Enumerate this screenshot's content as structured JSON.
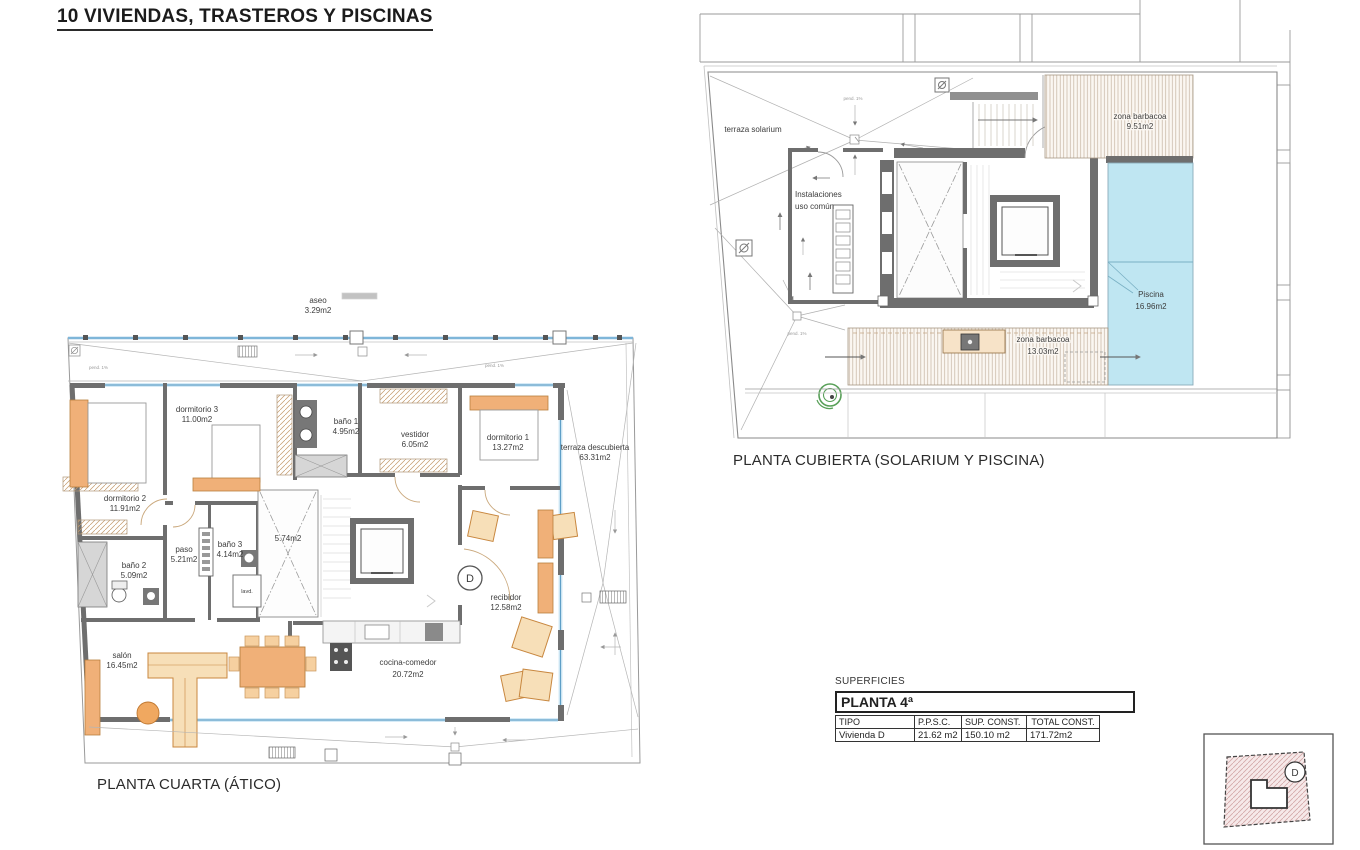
{
  "header": {
    "title": "10 VIVIENDAS, TRASTEROS Y PISCINAS"
  },
  "plan_atico": {
    "caption": "PLANTA CUARTA (ÁTICO)",
    "unit_badge": "D",
    "rooms": [
      {
        "line1": "aseo",
        "line2": "3.29m2"
      },
      {
        "line1": "dormitorio 3",
        "line2": "11.00m2"
      },
      {
        "line1": "baño 1",
        "line2": "4.95m2"
      },
      {
        "line1": "vestidor",
        "line2": "6.05m2"
      },
      {
        "line1": "dormitorio 1",
        "line2": "13.27m2"
      },
      {
        "line1": "terraza descubierta",
        "line2": "63.31m2"
      },
      {
        "line1": "dormitorio 2",
        "line2": "11.91m2"
      },
      {
        "line1": "baño 2",
        "line2": "5.09m2"
      },
      {
        "line1": "paso",
        "line2": "5.21m2"
      },
      {
        "line1": "baño 3",
        "line2": "4.14m2"
      },
      {
        "line1": "5.74m2",
        "line2": ""
      },
      {
        "line1": "recibidor",
        "line2": "12.58m2"
      },
      {
        "line1": "salón",
        "line2": "16.45m2"
      },
      {
        "line1": "cocina-comedor",
        "line2": "20.72m2"
      },
      {
        "line1": "lavd.",
        "line2": ""
      }
    ]
  },
  "plan_cubierta": {
    "caption": "PLANTA CUBIERTA (SOLARIUM Y PISCINA)",
    "rooms": [
      {
        "line1": "terraza solarium",
        "line2": ""
      },
      {
        "line1": "zona barbacoa",
        "line2": "9.51m2"
      },
      {
        "line1": "Instalaciones",
        "line2": "uso común"
      },
      {
        "line1": "Piscina",
        "line2": "16.96m2"
      },
      {
        "line1": "zona barbacoa",
        "line2": "13.03m2"
      }
    ]
  },
  "drawing_labels": {
    "pend": "pend. 1%"
  },
  "surfaces_table": {
    "label": "SUPERFICIES",
    "floor_title": "PLANTA 4ª",
    "columns": [
      "TIPO",
      "P.P.S.C.",
      "SUP. CONST.",
      "TOTAL CONST."
    ],
    "row": {
      "tipo": "Vivienda D",
      "ppsc": "21.62 m2",
      "sup_const": "150.10 m2",
      "total_const": "171.72m2"
    }
  },
  "key_plan": {
    "unit_badge": "D"
  },
  "colors": {
    "wall": "#6e6e6e",
    "window_line": "#5f9fc7",
    "window_fill": "#d6ebf7",
    "pool": "#bfe6f2",
    "furniture": "#f0b078",
    "furniture_light": "#f7dfb8",
    "hatch_line": "#c3b2a0",
    "shower_green": "#58a058",
    "keyplan_pink": "#f6e9e9"
  }
}
